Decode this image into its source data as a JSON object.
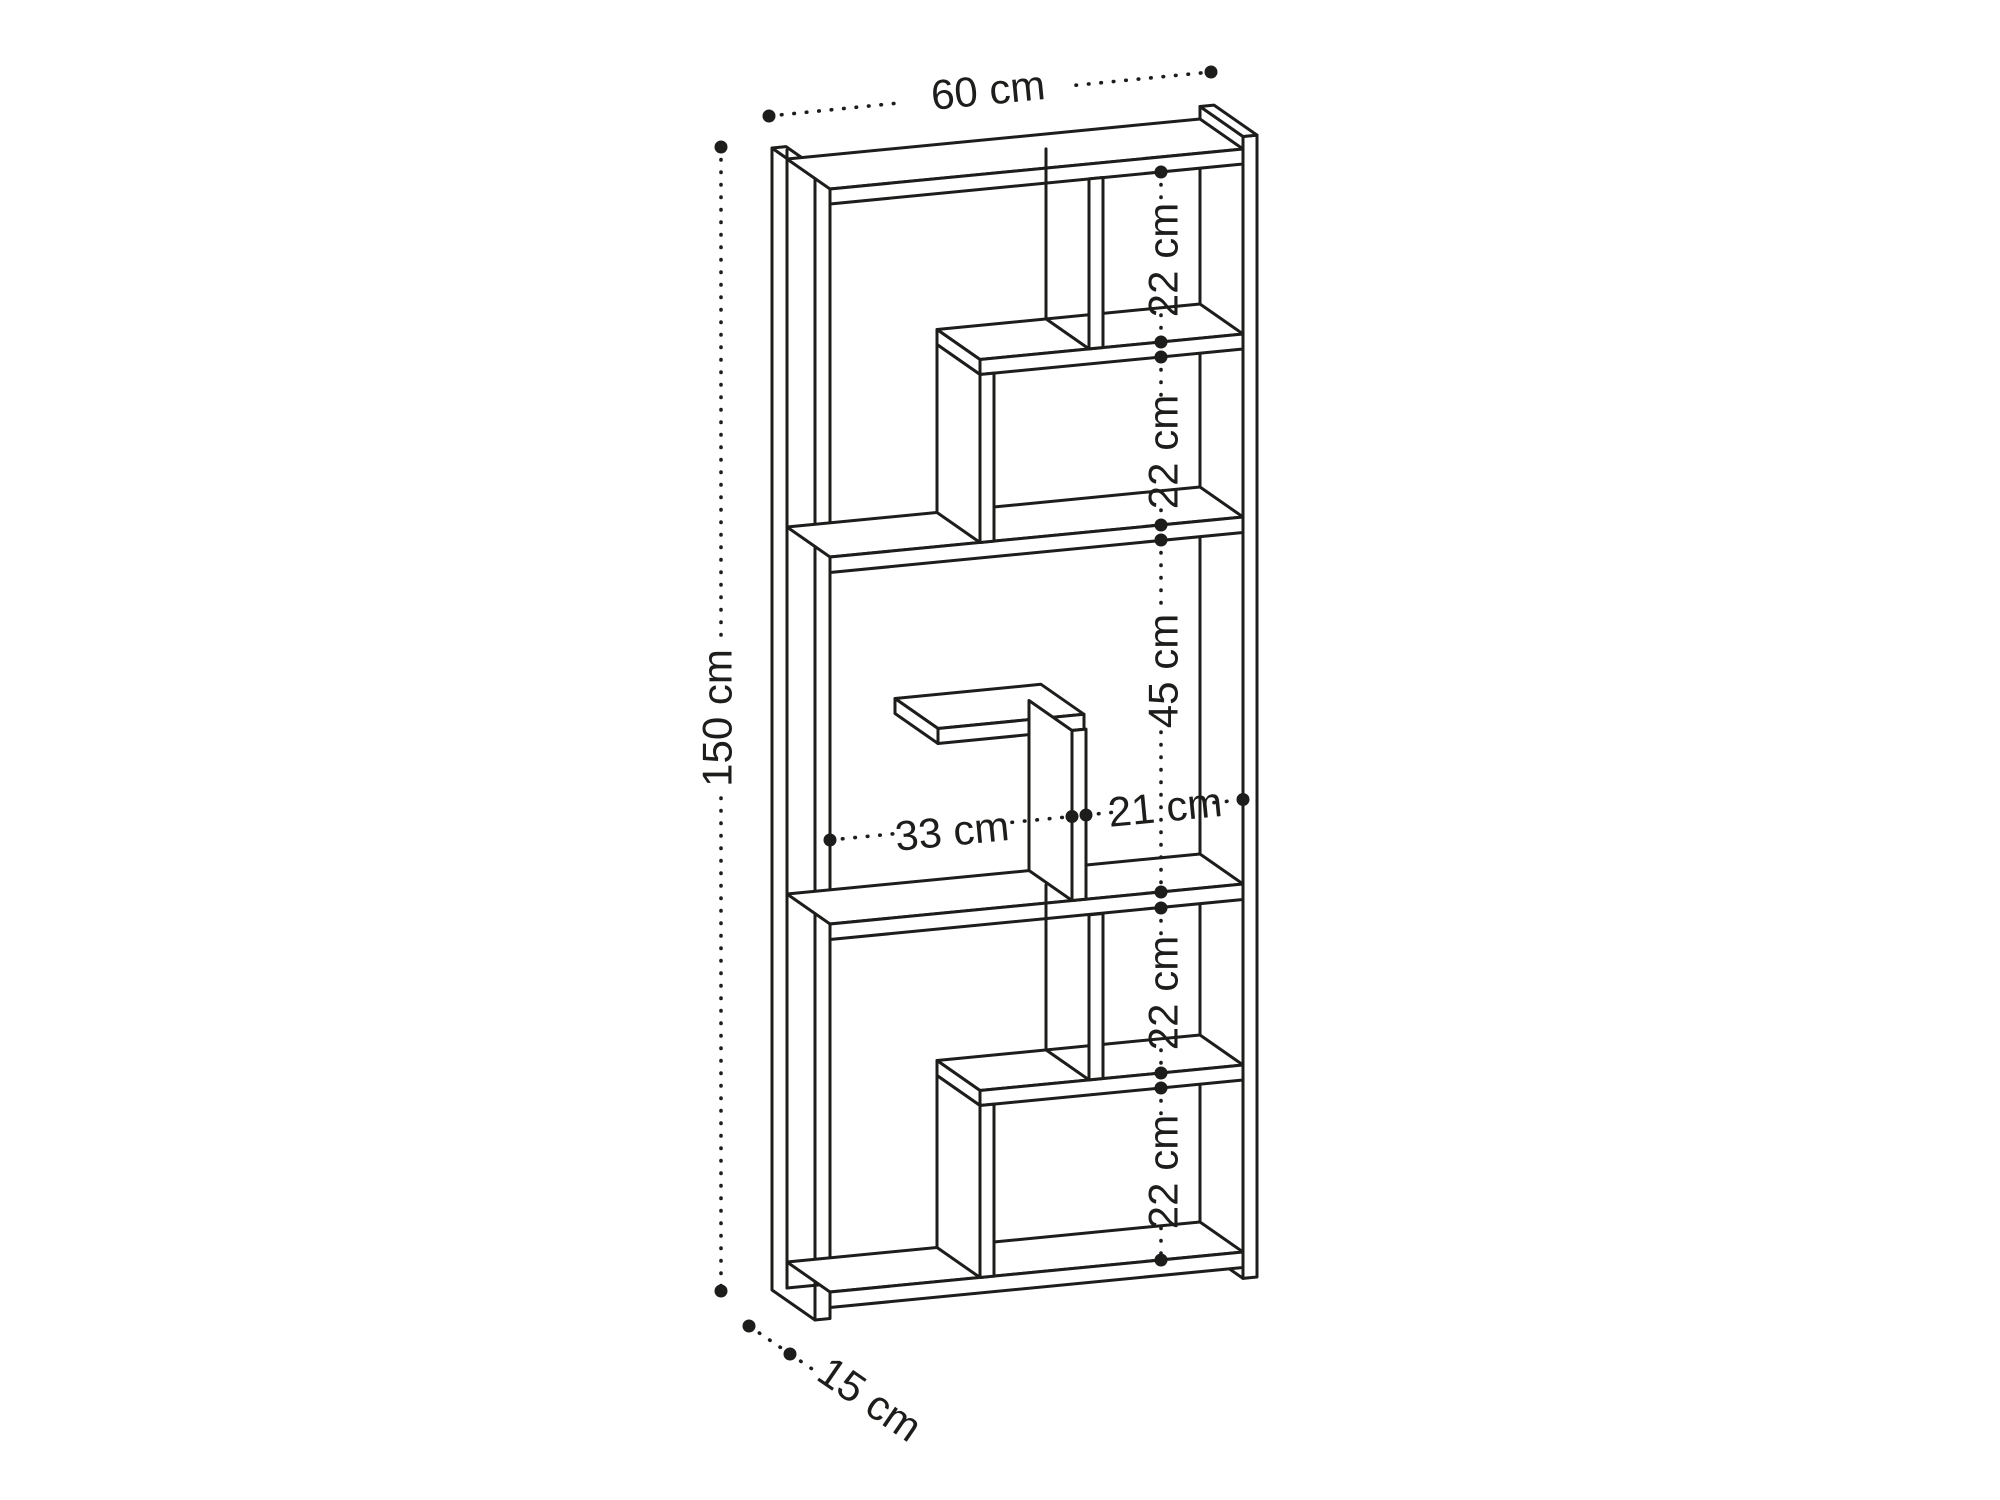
{
  "diagram": {
    "subject": "bookshelf-dimension-drawing",
    "colors": {
      "line": "#1d1d1b",
      "background": "#ffffff"
    },
    "dimensions": {
      "width": "60 cm",
      "height": "150 cm",
      "depth": "15 cm",
      "sections": [
        "22 cm",
        "22 cm",
        "45 cm",
        "22 cm",
        "22 cm"
      ],
      "shelf_left": "33 cm",
      "shelf_right": "21 cm"
    }
  }
}
